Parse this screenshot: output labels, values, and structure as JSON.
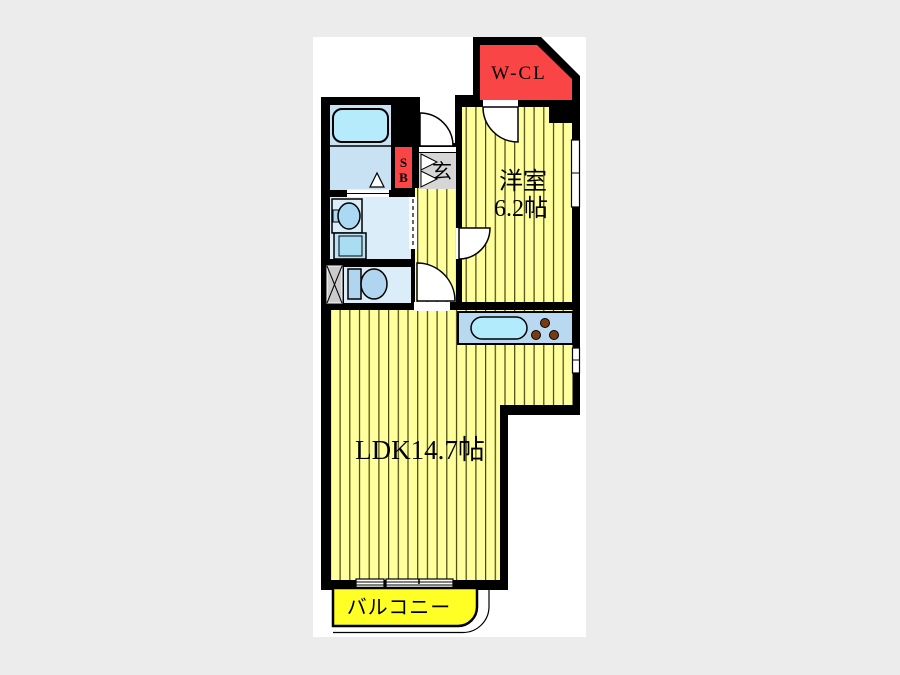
{
  "plan": {
    "type": "floor-plan",
    "rooms": {
      "walk_in_closet": {
        "label": "W-CL"
      },
      "bedroom": {
        "name": "洋室",
        "size": "6.2帖"
      },
      "ldk": {
        "label": "LDK14.7帖"
      },
      "balcony": {
        "label": "バルコニー"
      },
      "entrance": {
        "label": "玄"
      },
      "shoe_box": {
        "line1": "S",
        "line2": "B"
      }
    },
    "fixtures": [
      "bathtub",
      "wash-basin",
      "washing-machine",
      "toilet",
      "kitchen-sink",
      "stove-burners",
      "pipe-space"
    ],
    "colors": {
      "page_bg": "#ECECEC",
      "plan_bg": "#FFFFFF",
      "wall": "#000000",
      "closet_red": "#F94545",
      "room_yellow": "#FFFF9E",
      "stripe_line": "#45450F",
      "balcony_yellow": "#FFFF26",
      "bath_floor": "#C8E2F4",
      "tub_cyan": "#B5EBFB",
      "wash_floor": "#DAEDF9",
      "fixture_blue": "#AFD5F0",
      "counter_blue": "#B9D9F1",
      "burner_brown": "#7B3B10",
      "entrance_gray": "#D6D6D6",
      "ps_gray": "#CBCBCB"
    }
  }
}
